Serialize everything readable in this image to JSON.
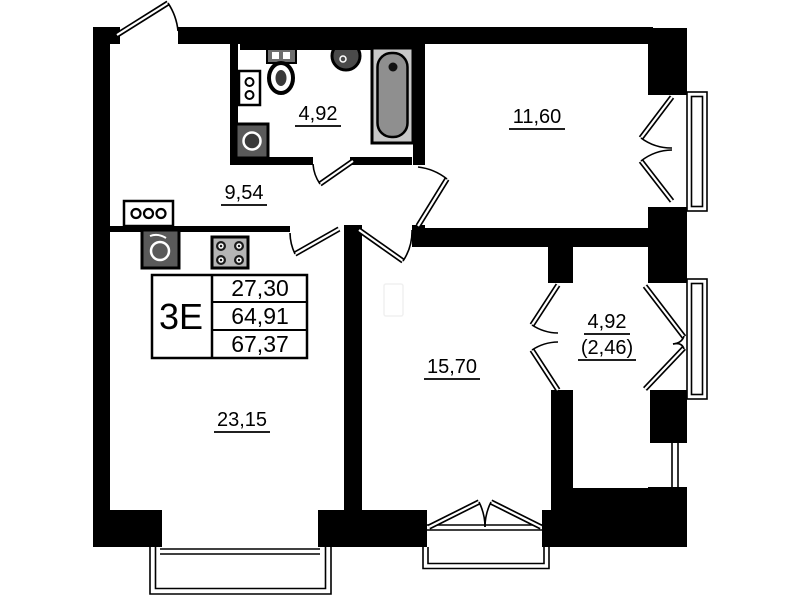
{
  "colors": {
    "wall": "#000000",
    "background": "#ffffff",
    "fixture_dark": "#555555",
    "fixture_gray": "#8f8f8f"
  },
  "rooms": {
    "hallway": {
      "area": "9,54"
    },
    "bathroom": {
      "area": "4,92"
    },
    "bedroom": {
      "area": "11,60"
    },
    "kitchen_living": {
      "area": "23,15"
    },
    "living_room": {
      "area": "15,70"
    },
    "balcony": {
      "area": "4,92",
      "area_reduced": "(2,46)"
    }
  },
  "info_table": {
    "unit_type": "3Е",
    "rows": [
      "27,30",
      "64,91",
      "67,37"
    ]
  },
  "fixtures": [
    "toilet",
    "wall-sink",
    "bathtub",
    "appliance-two-knob",
    "washbasin",
    "kitchen-sink",
    "stove-four-burner",
    "appliance-three-knob"
  ]
}
